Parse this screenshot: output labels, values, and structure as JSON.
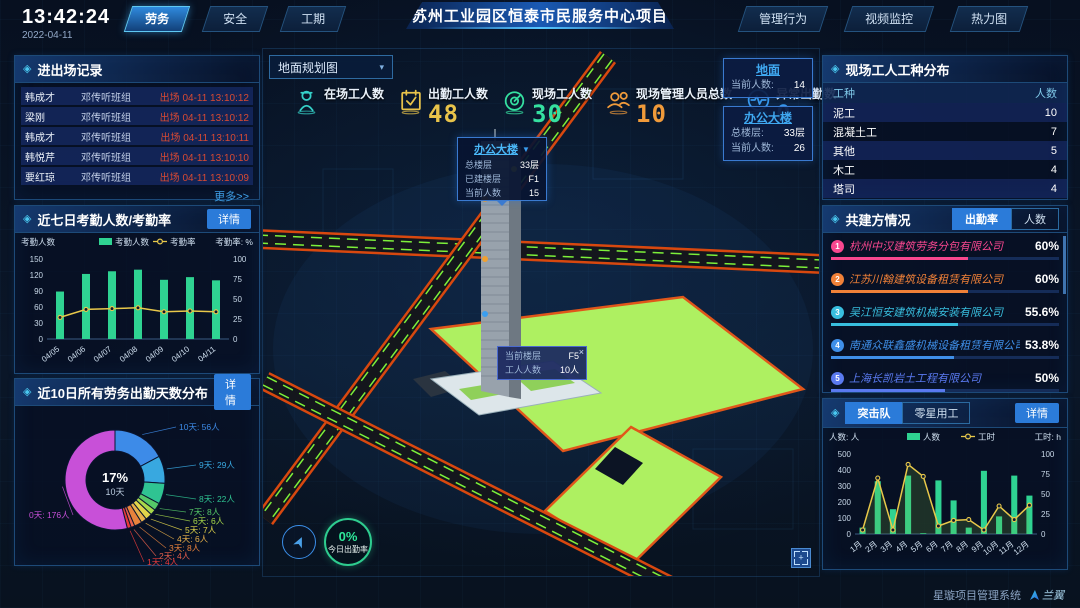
{
  "ui": {
    "diamond": "◈",
    "caret_down": "▼",
    "caret_small": "▾",
    "close": "×"
  },
  "topbar": {
    "time": "13:42:24",
    "date": "2022-04-11",
    "left_tabs": [
      {
        "label": "劳务",
        "active": true
      },
      {
        "label": "安全",
        "active": false
      },
      {
        "label": "工期",
        "active": false
      }
    ],
    "title": "苏州工业园区恒泰市民服务中心项目",
    "right_tabs": [
      {
        "label": "管理行为",
        "active": false
      },
      {
        "label": "视频监控",
        "active": false
      },
      {
        "label": "热力图",
        "active": false
      }
    ]
  },
  "entry_exit": {
    "title": "进出场记录",
    "more_label": "更多>>",
    "rows": [
      {
        "name": "韩成才",
        "team": "邓传听班组",
        "event": "出场 04-11 13:10:12"
      },
      {
        "name": "梁刚",
        "team": "邓传听班组",
        "event": "出场 04-11 13:10:12"
      },
      {
        "name": "韩成才",
        "team": "邓传听班组",
        "event": "出场 04-11 13:10:11"
      },
      {
        "name": "韩悦芹",
        "team": "邓传听班组",
        "event": "出场 04-11 13:10:10"
      },
      {
        "name": "要红琼",
        "team": "邓传听班组",
        "event": "出场 04-11 13:10:09"
      }
    ]
  },
  "weekly_panel": {
    "title": "近七日考勤人数/考勤率",
    "detail_label": "详情"
  },
  "dist_panel": {
    "title": "近10日所有劳务出勤天数分布",
    "detail_label": "详情"
  },
  "worker_types": {
    "title": "现场工人工种分布",
    "headers": [
      "工种",
      "人数"
    ],
    "rows": [
      {
        "type": "泥工",
        "count": "10"
      },
      {
        "type": "混凝土工",
        "count": "7"
      },
      {
        "type": "其他",
        "count": "5"
      },
      {
        "type": "木工",
        "count": "4"
      },
      {
        "type": "塔司",
        "count": "4"
      }
    ]
  },
  "partners": {
    "title": "共建方情况",
    "tabs": [
      {
        "label": "出勤率",
        "active": true
      },
      {
        "label": "人数",
        "active": false
      }
    ],
    "items": [
      {
        "rank": "1",
        "name": "杭州中汉建筑劳务分包有限公司",
        "pct": "60%",
        "pct_num": 60,
        "color": "#f8478f"
      },
      {
        "rank": "2",
        "name": "江苏川翰建筑设备租赁有限公司",
        "pct": "60%",
        "pct_num": 60,
        "color": "#f08138"
      },
      {
        "rank": "3",
        "name": "吴江恒安建筑机械安装有限公司",
        "pct": "55.6%",
        "pct_num": 55.6,
        "color": "#38bede"
      },
      {
        "rank": "4",
        "name": "南通众联鑫盛机械设备租赁有限公司",
        "pct": "53.8%",
        "pct_num": 53.8,
        "color": "#3f8fe8"
      },
      {
        "rank": "5",
        "name": "上海长凯岩土工程有限公司",
        "pct": "50%",
        "pct_num": 50,
        "color": "#5a7af0"
      },
      {
        "rank": "6",
        "name": "江苏法治建筑安装工程有限公司",
        "pct": "35.4%",
        "pct_num": 35.4,
        "color": "#8f55d8"
      }
    ]
  },
  "assault_panel": {
    "tabs": [
      {
        "label": "突击队",
        "active": true
      },
      {
        "label": "零星用工",
        "active": false
      }
    ],
    "detail_label": "详情"
  },
  "map": {
    "layer": "地面规划图",
    "stats": [
      {
        "label": "在场工人数",
        "value": "",
        "color": "#35d0c8",
        "icon": "worker-icon"
      },
      {
        "label": "出勤工人数",
        "value": "48",
        "color": "#e8c34a",
        "icon": "calendar-icon"
      },
      {
        "label": "现场工人数",
        "value": "30",
        "color": "#35e0a0",
        "icon": "gauge-icon"
      },
      {
        "label": "现场管理人员总数",
        "value": "10",
        "color": "#f09a3a",
        "icon": "people-icon"
      },
      {
        "label": "异常出勤数",
        "value": "0",
        "color": "#3a9ef0",
        "icon": "pulse-icon"
      }
    ],
    "building_popup": {
      "title": "办公大楼",
      "rows": [
        {
          "label": "总楼层",
          "value": "33层"
        },
        {
          "label": "已建楼层",
          "value": "F1"
        },
        {
          "label": "当前人数",
          "value": "15"
        }
      ]
    },
    "floor_tip": {
      "rows": [
        {
          "label": "当前楼层",
          "value": "F5"
        },
        {
          "label": "工人人数",
          "value": "10人"
        }
      ]
    },
    "floats": [
      {
        "title": "地面",
        "rows": [
          {
            "label": "当前人数:",
            "value": "14"
          }
        ]
      },
      {
        "title": "办公大楼",
        "rows": [
          {
            "label": "总楼层:",
            "value": "33层"
          },
          {
            "label": "当前人数:",
            "value": "26"
          }
        ]
      }
    ],
    "gauge": {
      "value": "0%",
      "label": "今日出勤率"
    }
  },
  "footer": {
    "system": "星璇项目管理系统",
    "logo": "兰翼"
  },
  "chart_data": [
    {
      "type": "bar-line",
      "title": "近七日考勤人数/考勤率",
      "categories": [
        "04/05",
        "04/06",
        "04/07",
        "04/08",
        "04/09",
        "04/10",
        "04/11"
      ],
      "series": [
        {
          "name": "考勤人数",
          "type": "bar",
          "values": [
            89,
            122,
            127,
            130,
            111,
            116,
            110
          ]
        },
        {
          "name": "考勤率",
          "type": "line",
          "values": [
            27,
            37,
            38,
            39,
            34,
            35,
            34
          ]
        }
      ],
      "ylabel": "考勤人数",
      "y2label": "考勤率: %",
      "ylim": [
        0,
        150
      ],
      "yticks": [
        0,
        30,
        60,
        90,
        120,
        150
      ],
      "y2lim": [
        0,
        100
      ],
      "y2ticks": [
        0,
        25,
        50,
        75,
        100
      ],
      "bar_color": "#2fd392",
      "line_color": "#e8c84a",
      "area": false,
      "legend": [
        "考勤人数",
        "考勤率"
      ]
    },
    {
      "type": "pie",
      "title": "近10日所有劳务出勤天数分布",
      "labels": [
        "10天",
        "9天",
        "8天",
        "7天",
        "6天",
        "5天",
        "4天",
        "3天",
        "2天",
        "1天",
        "0天"
      ],
      "values": [
        56,
        29,
        22,
        8,
        6,
        7,
        6,
        8,
        4,
        4,
        176
      ],
      "unit": "人",
      "colors": [
        "#3d8be8",
        "#38a8e0",
        "#2fc492",
        "#55c868",
        "#a8d84a",
        "#e0d44a",
        "#e8b04a",
        "#e8823c",
        "#e85f4a",
        "#e83a3a",
        "#c850d8"
      ],
      "center_pct": "17%",
      "center_sub": "10天"
    },
    {
      "type": "bar-line",
      "title": "突击队",
      "categories": [
        "1月",
        "2月",
        "3月",
        "4月",
        "5月",
        "6月",
        "7月",
        "8月",
        "9月",
        "10月",
        "11月",
        "12月"
      ],
      "series": [
        {
          "name": "人数",
          "type": "bar",
          "values": [
            40,
            330,
            155,
            365,
            5,
            335,
            210,
            40,
            395,
            110,
            365,
            240
          ]
        },
        {
          "name": "工时",
          "type": "line",
          "values": [
            5,
            70,
            5,
            87,
            72,
            10,
            17,
            18,
            5,
            35,
            18,
            36
          ]
        }
      ],
      "ylabel": "人数: 人",
      "y2label": "工时: h",
      "ylim": [
        0,
        500
      ],
      "yticks": [
        0,
        100,
        200,
        300,
        400,
        500
      ],
      "y2lim": [
        0,
        100
      ],
      "y2ticks": [
        0,
        25,
        50,
        75,
        100
      ],
      "bar_color": "#2fd392",
      "line_color": "#e8c84a",
      "area": true,
      "legend": [
        "人数",
        "工时"
      ]
    }
  ]
}
